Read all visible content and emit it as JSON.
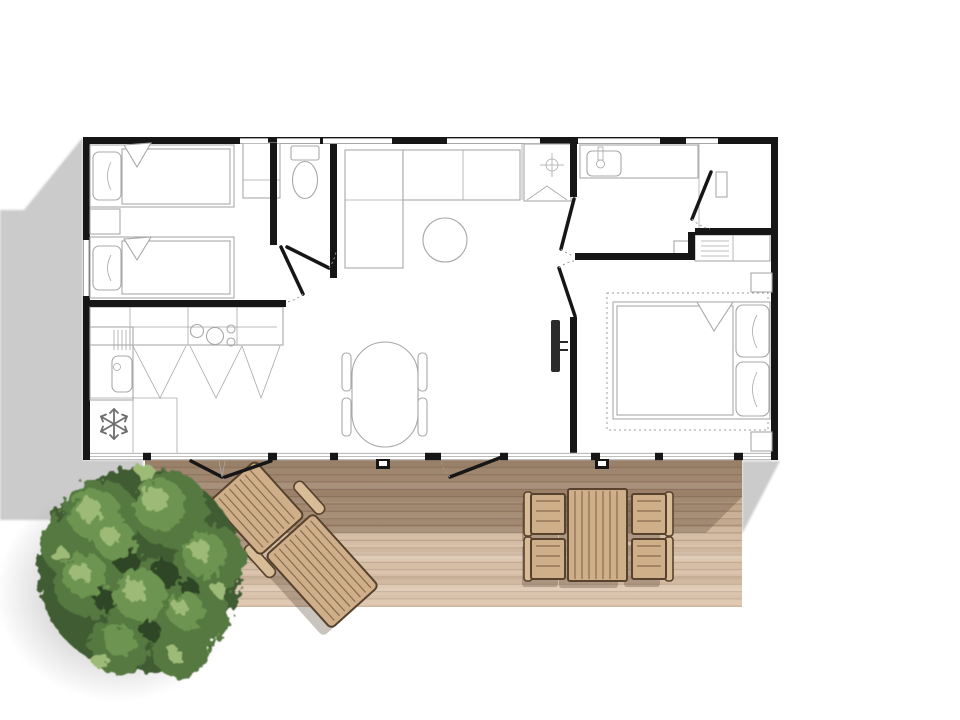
{
  "scene": {
    "type": "floor-plan-top-view",
    "description": "Top-view floor plan of a two-bedroom mobile home with wooden terrace, sun lounger, outdoor dining set and a tree",
    "canvas": {
      "width": 960,
      "height": 720
    }
  },
  "colors": {
    "wall": "#161616",
    "thin_line": "#a8a8a8",
    "mid_line": "#6f6f6f",
    "dash": "#9b9b9b",
    "ground_shadow": "#cbcbcb",
    "deck_plank_a": "#d2bba2",
    "deck_plank_b": "#c7ad92",
    "deck_plank_c": "#cfb59b",
    "deck_plank_d": "#bfa489",
    "deck_gap": "#a78d74",
    "deck_shade": "rgba(85,62,45,0.30)",
    "deck_light_wash": "rgba(255,238,224,0.28)",
    "wood_fill": "#cfae8a",
    "wood_fill_light": "#d8bb97",
    "wood_stroke": "#57422e",
    "wood_slat": "#8a6c4e",
    "furniture_shadow": "rgba(90,70,55,0.32)",
    "tree_shadow": "#8f8f8f",
    "tree_dark": "#3f5c33",
    "tree_mid": "#55793f",
    "tree_light": "#6d9551",
    "tree_highlight": "#9dbb77",
    "tree_spot": "#2f4527",
    "tv": "#2b2b2b"
  },
  "house": {
    "rooms": [
      {
        "name": "twin-bedroom",
        "furniture": [
          "single-bed-1",
          "single-bed-2",
          "nightstand",
          "pillows",
          "wardrobe"
        ]
      },
      {
        "name": "wc",
        "furniture": [
          "toilet"
        ]
      },
      {
        "name": "kitchen",
        "furniture": [
          "counter",
          "cooktop-4-burners",
          "sink-unit",
          "fridge-snowflake",
          "cabinet-doors"
        ]
      },
      {
        "name": "living-dining",
        "furniture": [
          "corner-sofa",
          "round-coffee-table",
          "oval-dining-table",
          "four-chairs",
          "wall-tv"
        ]
      },
      {
        "name": "shower-room",
        "furniture": [
          "shower-stall"
        ]
      },
      {
        "name": "bathroom",
        "furniture": [
          "washbasin-counter",
          "tap"
        ]
      },
      {
        "name": "entry",
        "furniture": [
          "door",
          "wall-shelf"
        ]
      },
      {
        "name": "master-bedroom",
        "furniture": [
          "double-bed",
          "two-pillows",
          "nightstand-top",
          "nightstand-bottom",
          "shelved-closet",
          "dotted-rug"
        ]
      }
    ],
    "openings": [
      "interior-doors-x5",
      "french-doors-to-terrace",
      "terrace-door",
      "windows"
    ]
  },
  "terrace": {
    "name": "wooden-deck",
    "items": [
      "sun-lounger",
      "outdoor-table",
      "outdoor-chair-x4",
      "threshold-step-x2"
    ]
  },
  "landscape": {
    "items": [
      "round-tree",
      "tree-soft-shadow",
      "building-cast-shadow-left",
      "deck-cast-shadow-right"
    ]
  }
}
